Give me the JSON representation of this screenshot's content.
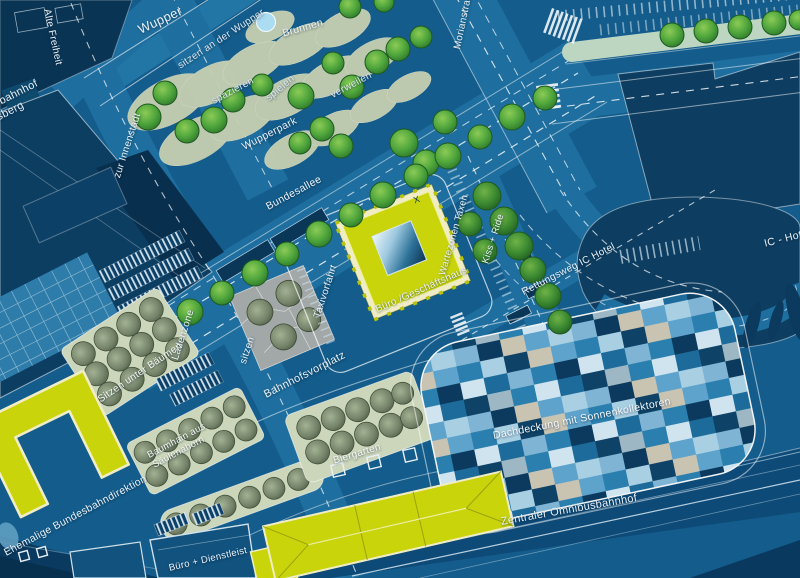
{
  "map": {
    "type": "architectural-site-plan",
    "labels": {
      "wupper": "Wupper",
      "alte_freiheit": "Alte Freiheit",
      "sitzen_wupper": "sitzen an der Wupper",
      "brunnen": "Brunnen",
      "spazieren": "spazieren",
      "spielen": "spielen",
      "verweilen": "verweilen",
      "wupperpark": "Wupperpark",
      "morianstrasse": "Morianstraße",
      "zur_innenstadt": "zur Innenstadt",
      "schwebebahnhof_line1": "Schwebebahnhof",
      "schwebebahnhof_line2": "Döppersberg",
      "bundesallee": "Bundesallee",
      "buero_geschaeftshaus": "Büro /Geschäftshaus",
      "x_marker": "X",
      "taxivorfahrt": "Taxivorfahrt",
      "wartezonen_taxen": "Wartezonen Taxen",
      "kiss_ride": "Kiss + Ride",
      "rettungsweg_ic_hotel": "Rettungsweg IC Hotel",
      "ic_hotel": "IC - Hotel",
      "bahnhofsvorplatz": "Bahnhofsvorplatz",
      "sitzen": "sitzen",
      "ladenzone": "Ladenzone",
      "sitzen_unter_baeumen": "Sitzen unter Bäumen",
      "baumhain_line1": "Baumhain aus",
      "baumhain_line2": "Säulenahorn",
      "biergarten": "Biergarten",
      "dachdeckung": "Dachdeckung mit Sonnenkollektoren",
      "zentraler_omnibusbahnhof": "Zentraler Omnibusbahnhof",
      "ehemalige_bundesbahndirektion": "Ehemalige Bundesbahndirektion",
      "buero_dienstleist": "Büro + Dienstleist"
    },
    "colors": {
      "background": "#135c8b",
      "road": "#1e6f9f",
      "dark_building": "#0d3d60",
      "yellow_building": "#c9d40b",
      "building_outline_cream": "#f0edc6",
      "park_sage": "#c7cfb0",
      "tree_green": "#4ea53b",
      "plaza_gray": "#a2a8a8",
      "fountain_blue": "#abdcf2",
      "mosaic_light": "#a9cfe3",
      "mosaic_dark": "#0e4266"
    }
  }
}
